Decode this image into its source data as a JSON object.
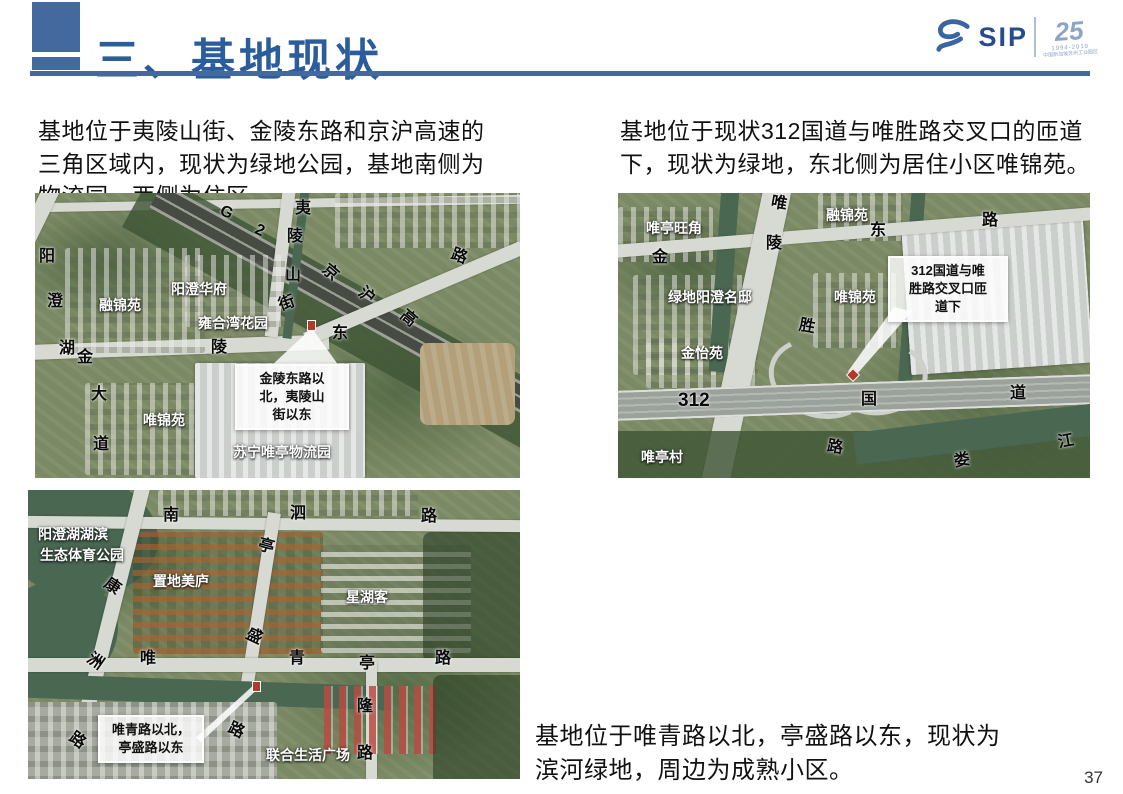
{
  "accent_color": "#44699E",
  "header": {
    "title": "三、基地现状",
    "logo": {
      "sip": "SIP",
      "anniversary": "25",
      "dates": "1994-2019",
      "org": "中国新加坡苏州工业园区"
    }
  },
  "paragraphs": {
    "top_left": "基地位于夷陵山街、金陵东路和京沪高速的三角区域内，现状为绿地公园，基地南侧为物流园，西侧为住区。",
    "top_right": "基地位于现状312国道与唯胜路交叉口的匝道下，现状为绿地，东北侧为居住小区唯锦苑。",
    "bottom_right": "基地位于唯青路以北，亭盛路以东，现状为滨河绿地，周边为成熟小区。"
  },
  "page_number": "37",
  "maps": [
    {
      "name": "site-1-jinling-east-road",
      "road_labels": [
        {
          "t": "阳",
          "x": 4,
          "y": 56
        },
        {
          "t": "澄",
          "x": 12,
          "y": 101
        },
        {
          "t": "湖",
          "x": 24,
          "y": 148
        },
        {
          "t": "金",
          "x": 42,
          "y": 157
        },
        {
          "t": "大",
          "x": 56,
          "y": 194
        },
        {
          "t": "道",
          "x": 58,
          "y": 244
        },
        {
          "t": "陵",
          "x": 176,
          "y": 147
        },
        {
          "t": "东",
          "x": 297,
          "y": 133
        },
        {
          "t": "路",
          "x": 416,
          "y": 56,
          "r": 20
        },
        {
          "t": "夷",
          "x": 260,
          "y": 8
        },
        {
          "t": "陵",
          "x": 252,
          "y": 36
        },
        {
          "t": "山",
          "x": 250,
          "y": 75
        },
        {
          "t": "街",
          "x": 244,
          "y": 103,
          "r": -20
        },
        {
          "t": "G",
          "x": 185,
          "y": 12,
          "r": 25
        },
        {
          "t": "2",
          "x": 220,
          "y": 30,
          "r": 25
        },
        {
          "t": "京",
          "x": 287,
          "y": 72,
          "r": 40
        },
        {
          "t": "沪",
          "x": 323,
          "y": 95,
          "r": 40
        },
        {
          "t": "高",
          "x": 365,
          "y": 118,
          "r": 40
        }
      ],
      "place_labels": [
        {
          "t": "融锦苑",
          "x": 64,
          "y": 104
        },
        {
          "t": "阳澄华府",
          "x": 136,
          "y": 88
        },
        {
          "t": "雍合湾花园",
          "x": 163,
          "y": 122
        },
        {
          "t": "唯锦苑",
          "x": 108,
          "y": 219
        },
        {
          "t": "苏宁唯亭物流园",
          "x": 198,
          "y": 251
        }
      ],
      "callout": {
        "lines": [
          "金陵东路以",
          "北，夷陵山",
          "街以东"
        ]
      }
    },
    {
      "name": "site-2-g312-weisheng-interchange",
      "road_labels": [
        {
          "t": "金",
          "x": 34,
          "y": 57
        },
        {
          "t": "陵",
          "x": 148,
          "y": 43
        },
        {
          "t": "东",
          "x": 252,
          "y": 30
        },
        {
          "t": "路",
          "x": 364,
          "y": 20
        },
        {
          "t": "唯",
          "x": 153,
          "y": 3,
          "r": 10
        },
        {
          "t": "胜",
          "x": 181,
          "y": 126,
          "r": 10
        },
        {
          "t": "路",
          "x": 209,
          "y": 247,
          "r": 10
        },
        {
          "t": "312",
          "x": 60,
          "y": 198,
          "fs": 19
        },
        {
          "t": "国",
          "x": 243,
          "y": 199
        },
        {
          "t": "道",
          "x": 392,
          "y": 193
        },
        {
          "t": "娄",
          "x": 336,
          "y": 260,
          "r": -10
        },
        {
          "t": "江",
          "x": 440,
          "y": 241,
          "r": -10
        }
      ],
      "place_labels": [
        {
          "t": "唯亭旺角",
          "x": 28,
          "y": 27
        },
        {
          "t": "融锦苑",
          "x": 208,
          "y": 14
        },
        {
          "t": "绿地阳澄名邸",
          "x": 50,
          "y": 96
        },
        {
          "t": "唯锦苑",
          "x": 216,
          "y": 96
        },
        {
          "t": "金怡苑",
          "x": 63,
          "y": 152
        },
        {
          "t": "唯亭村",
          "x": 23,
          "y": 256
        }
      ],
      "callout": {
        "lines": [
          "312国道与唯",
          "胜路交叉口匝",
          "道下"
        ]
      }
    },
    {
      "name": "site-3-weiqing-tingsheng",
      "road_labels": [
        {
          "t": "南",
          "x": 135,
          "y": 18
        },
        {
          "t": "泗",
          "x": 262,
          "y": 16
        },
        {
          "t": "路",
          "x": 393,
          "y": 19
        },
        {
          "t": "康",
          "x": 76,
          "y": 89,
          "r": 35
        },
        {
          "t": "洲",
          "x": 59,
          "y": 164,
          "r": 35
        },
        {
          "t": "路",
          "x": 41,
          "y": 243,
          "r": 35
        },
        {
          "t": "亭",
          "x": 230,
          "y": 49,
          "r": 15
        },
        {
          "t": "盛",
          "x": 218,
          "y": 139,
          "r": 25
        },
        {
          "t": "路",
          "x": 200,
          "y": 233,
          "r": 25
        },
        {
          "t": "唯",
          "x": 112,
          "y": 161
        },
        {
          "t": "青",
          "x": 261,
          "y": 161
        },
        {
          "t": "路",
          "x": 407,
          "y": 161
        },
        {
          "t": "亭",
          "x": 331,
          "y": 166
        },
        {
          "t": "隆",
          "x": 329,
          "y": 209
        },
        {
          "t": "路",
          "x": 329,
          "y": 256
        }
      ],
      "place_labels": [
        {
          "t": "阳澄湖湖滨",
          "x": 10,
          "y": 36
        },
        {
          "t": "生态体育公园",
          "x": 12,
          "y": 57
        },
        {
          "t": "置地美庐",
          "x": 125,
          "y": 83
        },
        {
          "t": "星湖客",
          "x": 318,
          "y": 99
        },
        {
          "t": "联合生活广场",
          "x": 238,
          "y": 257
        }
      ],
      "callout": {
        "lines": [
          "唯青路以北，",
          "亭盛路以东"
        ]
      }
    }
  ]
}
